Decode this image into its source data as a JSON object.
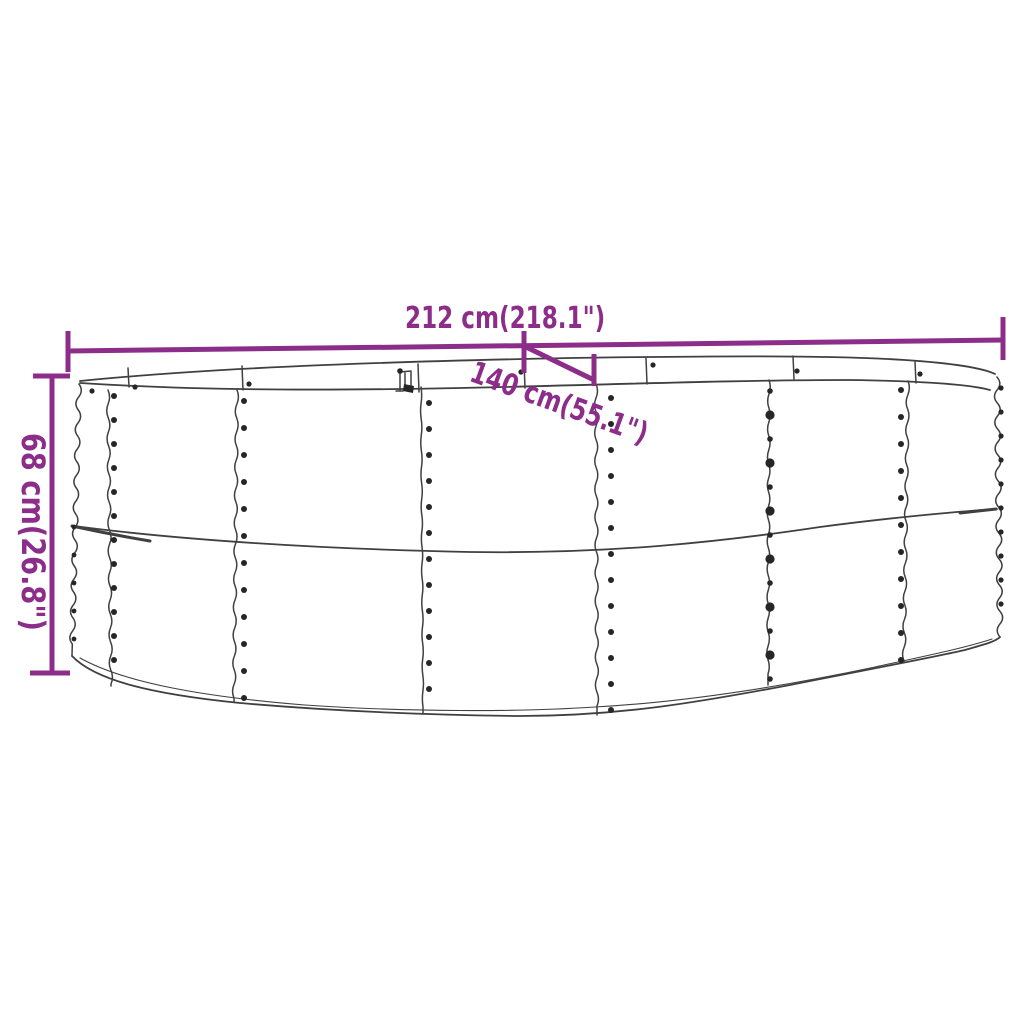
{
  "diagram": {
    "width_label": "212 cm(218.1\")",
    "depth_label": "140 cm(55.1\")",
    "height_label": "68 cm(26.8\")",
    "colors": {
      "accent": "#8c2d8a",
      "line": "#404040",
      "dot": "#262626",
      "background": "#ffffff"
    }
  }
}
